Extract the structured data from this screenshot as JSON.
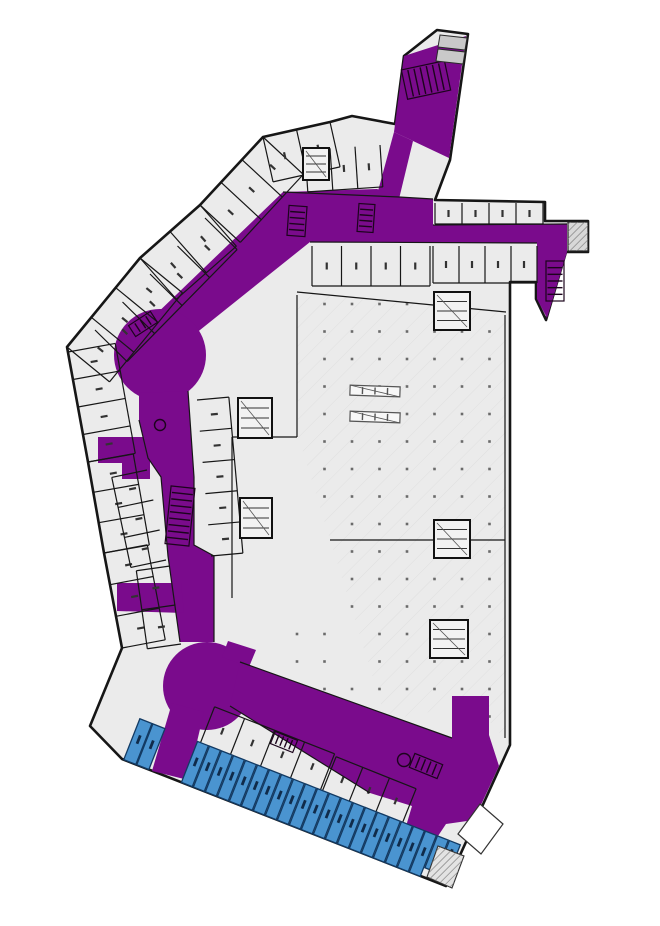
{
  "plan": {
    "kind": "floor-plan",
    "base": {
      "background": "#ffffff",
      "floor_fill": "#ebebeb",
      "wall_color": "#161616",
      "core_fill": "#f2f2f2",
      "grid_dot_color": "#4a4a4a",
      "canopy_fill": "#d8d8d8",
      "hatch_color": "#dadada"
    },
    "highlighted_systems": [
      {
        "id": "circulation",
        "color": "#7a0b8c"
      },
      {
        "id": "retail-units",
        "color": "#4a94d0",
        "outline": "#123a63",
        "unit_count": 24
      }
    ],
    "features": {
      "rotundas": 2,
      "escalator_banks": 8,
      "elevator_symbols": 2,
      "entrances": 3
    }
  }
}
